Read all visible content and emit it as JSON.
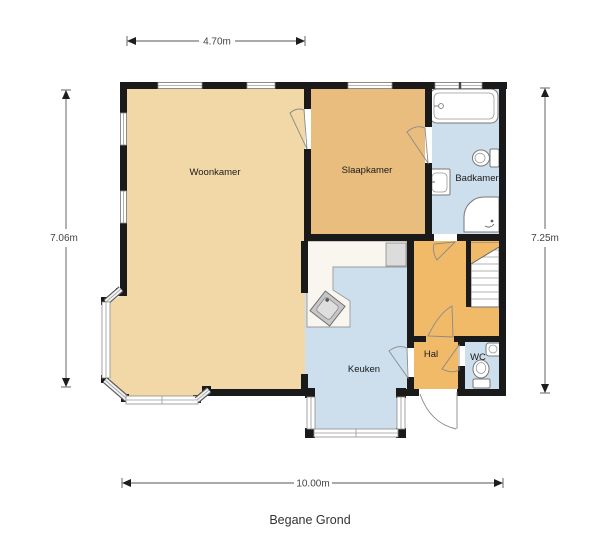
{
  "title": "Begane Grond",
  "dimensions": {
    "top": "4.70m",
    "left": "7.06m",
    "right": "7.25m",
    "bottom": "10.00m"
  },
  "rooms": {
    "woonkamer": {
      "label": "Woonkamer"
    },
    "slaapkamer": {
      "label": "Slaapkamer"
    },
    "badkamer": {
      "label": "Badkamer"
    },
    "keuken": {
      "label": "Keuken"
    },
    "hal": {
      "label": "Hal"
    },
    "wc": {
      "label": "WC"
    }
  },
  "colors": {
    "wall": "#1a1a1a",
    "woonkamer_floor": "#f2d8a6",
    "slaapkamer_floor": "#e9bd7e",
    "hal_floor": "#f0ba68",
    "wet_floor": "#cddfec",
    "counter": "#f8f6ee",
    "appliance": "#dcdcdc",
    "label_text": "#1a1a1a",
    "dimension_text": "#444444"
  }
}
